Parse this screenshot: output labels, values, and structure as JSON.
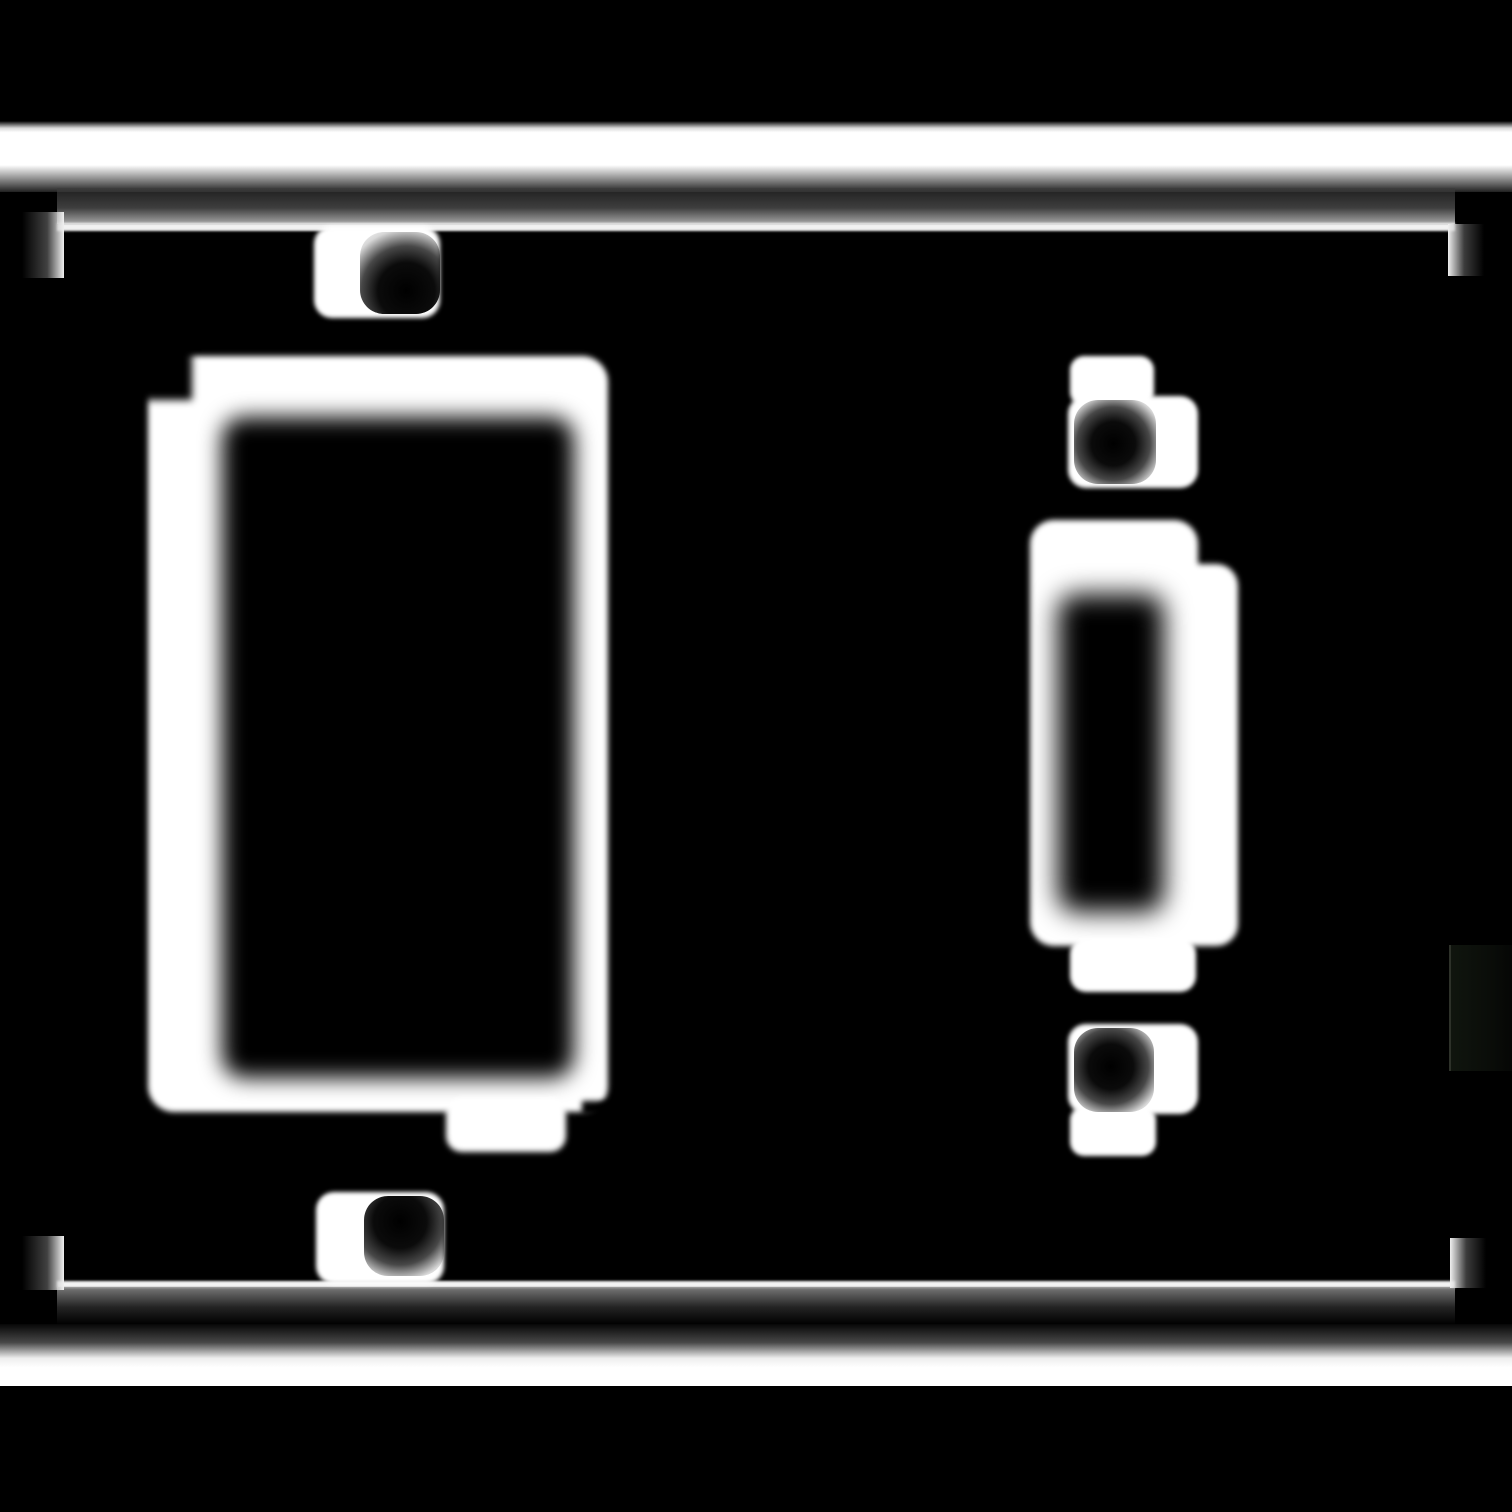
{
  "scene": {
    "kind": "monochrome blurred line-art mask (no text visible)",
    "subject": "two-gang wall plate: rocker (decora) opening on the left, toggle switch opening on the right",
    "colors": {
      "background": "#000000",
      "stroke": "#ffffff",
      "shading_gray": "#6e6e6e",
      "cutout_black": "#000000",
      "right_edge_dark_patch": "#0c110b"
    },
    "components": {
      "top_highlight_band": "full-width soft white band near top",
      "bottom_highlight_band": "full-width soft white band near bottom",
      "plate_frame": "thin rectangle outline with short corner ticks",
      "rocker_opening": "large rounded-rectangle ring with black cutout and bottom tab",
      "rocker_screw_top": "white boss with dark screw recess",
      "rocker_screw_bottom": "white boss with dark screw recess",
      "toggle_opening": "double-outlined rounded plate with dark toggle slot and bottom tab",
      "toggle_screw_top": "white boss with dark screw recess",
      "toggle_screw_bottom": "white boss with dark screw recess",
      "right_edge_patch": "very faint dark rectangle at right image edge"
    }
  }
}
